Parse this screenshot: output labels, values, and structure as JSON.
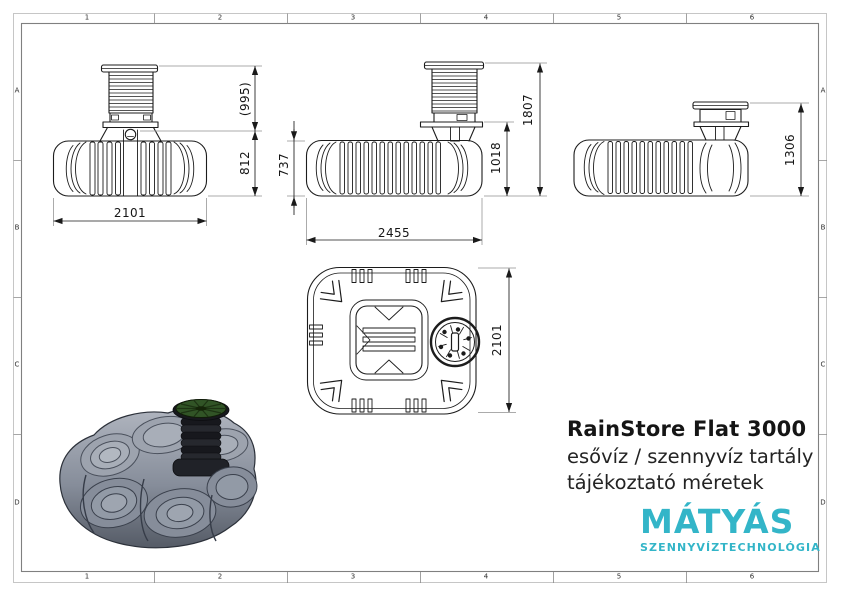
{
  "sheet": {
    "grid_columns": [
      "1",
      "2",
      "3",
      "4",
      "5",
      "6"
    ],
    "grid_rows": [
      "A",
      "B",
      "C",
      "D"
    ]
  },
  "drawing": {
    "front_view": {
      "width_mm": "2101",
      "riser_height_mm": "(995)",
      "body_height_mm": "812"
    },
    "side_view": {
      "length_mm": "2455",
      "body_height_mm": "737",
      "shoulder_height_mm": "1018",
      "total_height_mm": "1807"
    },
    "end_view": {
      "total_height_mm": "1306"
    },
    "top_view": {
      "width_mm": "2101"
    }
  },
  "title_block": {
    "product_name": "RainStore Flat 3000",
    "description_line1": "esővíz / szennyvíz tartály",
    "description_line2": "tájékoztató méretek"
  },
  "logo": {
    "brand": "MÁTYÁS",
    "tagline": "SZENNYVÍZTECHNOLÓGIA"
  },
  "colors": {
    "brand_teal": "#33b5c8",
    "line_black": "#1c1c1c",
    "tank_gray": "#8d94a1",
    "riser_black": "#1c1e24",
    "lid_green": "#315426"
  }
}
